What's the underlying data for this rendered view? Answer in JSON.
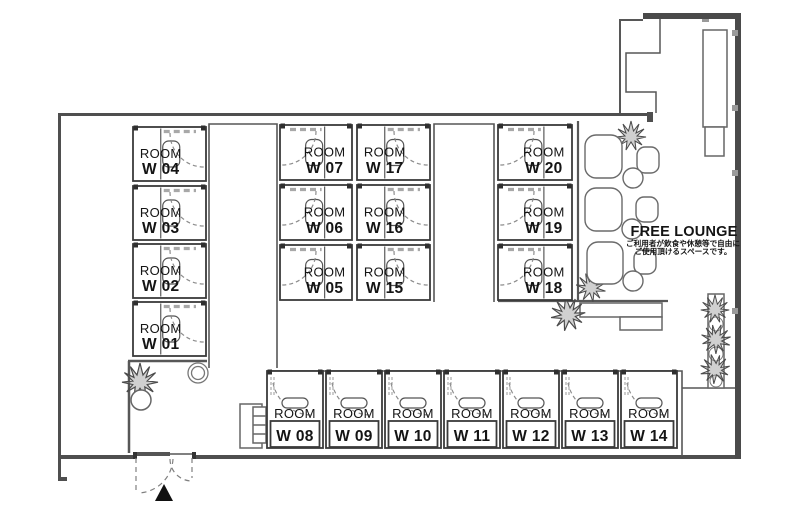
{
  "plan_name": "office-booth-floorplan",
  "room_word": "ROOM",
  "lounge": {
    "title": "FREE LOUNGE",
    "note_lines": [
      "ご利用者が飲食や休憩等で自由に",
      "ご使用頂けるスペースです。"
    ]
  },
  "colors": {
    "wall_thick": "#4a4a4a",
    "wall_thin": "#555555",
    "room_border": "#3a3a3a",
    "dash": "#9a9a9a",
    "note_red": "#e8352c",
    "text": "#141414"
  },
  "entrance": {
    "marker": "triangle-up"
  },
  "rooms": [
    {
      "id": "W 01",
      "x": 133,
      "y": 302,
      "w": 73,
      "h": 54,
      "door": "right"
    },
    {
      "id": "W 02",
      "x": 133,
      "y": 244,
      "w": 73,
      "h": 54,
      "door": "right"
    },
    {
      "id": "W 03",
      "x": 133,
      "y": 186,
      "w": 73,
      "h": 54,
      "door": "right"
    },
    {
      "id": "W 04",
      "x": 133,
      "y": 127,
      "w": 73,
      "h": 54,
      "door": "right"
    },
    {
      "id": "W 05",
      "x": 280,
      "y": 245,
      "w": 72,
      "h": 55,
      "door": "left"
    },
    {
      "id": "W 06",
      "x": 280,
      "y": 185,
      "w": 72,
      "h": 55,
      "door": "left"
    },
    {
      "id": "W 07",
      "x": 280,
      "y": 125,
      "w": 72,
      "h": 55,
      "door": "left"
    },
    {
      "id": "W 08",
      "x": 267,
      "y": 371,
      "w": 56,
      "h": 77,
      "door": "top"
    },
    {
      "id": "W 09",
      "x": 326,
      "y": 371,
      "w": 56,
      "h": 77,
      "door": "top"
    },
    {
      "id": "W 10",
      "x": 385,
      "y": 371,
      "w": 56,
      "h": 77,
      "door": "top"
    },
    {
      "id": "W 11",
      "x": 444,
      "y": 371,
      "w": 56,
      "h": 77,
      "door": "top"
    },
    {
      "id": "W 12",
      "x": 503,
      "y": 371,
      "w": 56,
      "h": 77,
      "door": "top"
    },
    {
      "id": "W 13",
      "x": 562,
      "y": 371,
      "w": 56,
      "h": 77,
      "door": "top"
    },
    {
      "id": "W 14",
      "x": 621,
      "y": 371,
      "w": 56,
      "h": 77,
      "door": "top"
    },
    {
      "id": "W 15",
      "x": 357,
      "y": 245,
      "w": 73,
      "h": 55,
      "door": "right"
    },
    {
      "id": "W 16",
      "x": 357,
      "y": 185,
      "w": 73,
      "h": 55,
      "door": "right"
    },
    {
      "id": "W 17",
      "x": 357,
      "y": 125,
      "w": 73,
      "h": 55,
      "door": "right"
    },
    {
      "id": "W 18",
      "x": 498,
      "y": 245,
      "w": 74,
      "h": 55,
      "door": "left"
    },
    {
      "id": "W 19",
      "x": 498,
      "y": 185,
      "w": 74,
      "h": 55,
      "door": "left"
    },
    {
      "id": "W 20",
      "x": 498,
      "y": 125,
      "w": 74,
      "h": 55,
      "door": "left"
    }
  ]
}
